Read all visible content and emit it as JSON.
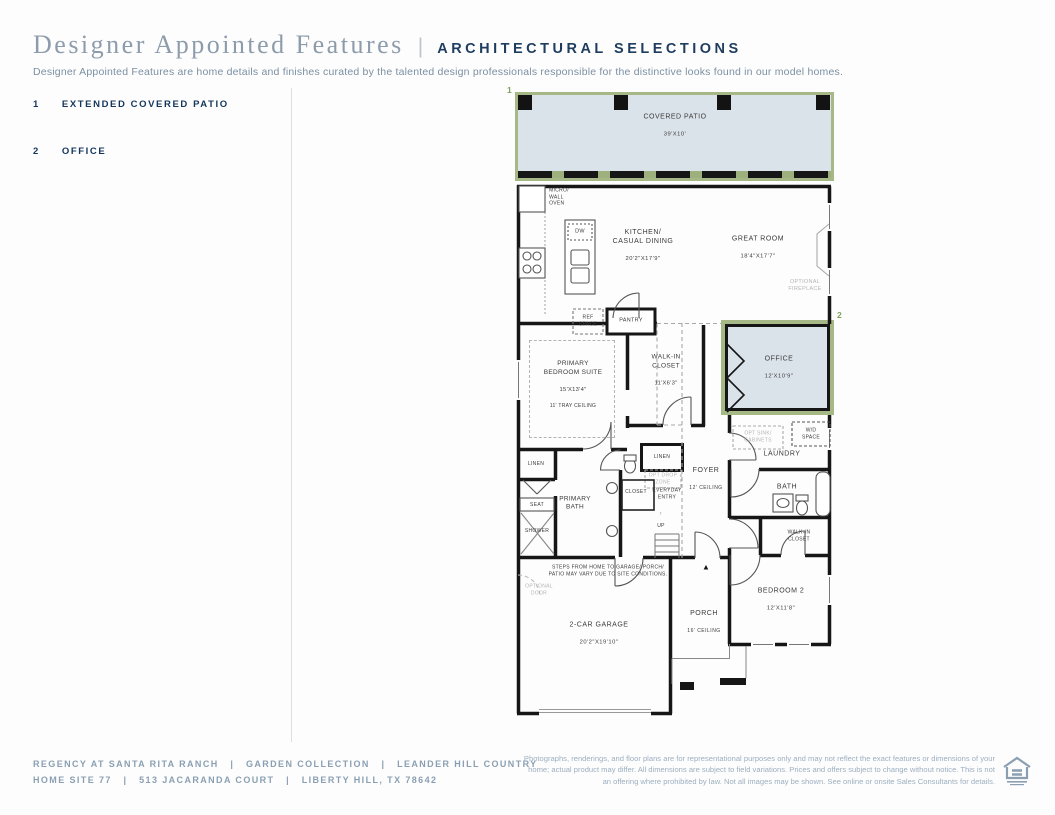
{
  "header": {
    "title": "Designer Appointed Features",
    "separator": "|",
    "category": "ARCHITECTURAL SELECTIONS",
    "description": "Designer Appointed Features are home details and finishes curated by the talented design professionals responsible for the distinctive looks found in our model homes."
  },
  "features": [
    {
      "number": "1",
      "label": "EXTENDED COVERED PATIO"
    },
    {
      "number": "2",
      "label": "OFFICE"
    }
  ],
  "plan": {
    "markers": {
      "patio": "1",
      "office": "2"
    },
    "covered_patio": {
      "label": "COVERED PATIO",
      "dims": "39'X10'"
    },
    "micro_wall_oven": "MICRO/\nWALL\nOVEN",
    "dw": "DW",
    "kitchen": {
      "label": "KITCHEN/\nCASUAL DINING",
      "dims": "20'2\"X17'9\""
    },
    "great_room": {
      "label": "GREAT ROOM",
      "dims": "18'4\"X17'7\""
    },
    "optional_fireplace": "OPTIONAL\nFIREPLACE",
    "ref_space": "REF\nSPACE",
    "pantry": "PANTRY",
    "office": {
      "label": "OFFICE",
      "dims": "12'X10'9\""
    },
    "opt_sink_cabinets": "OPT SINK/\nCABINETS",
    "wd_space": "W/D\nSPACE",
    "laundry": "LAUNDRY",
    "bath": "BATH",
    "walk_in_closet_2": "WALK-IN\nCLOSET",
    "bedroom_2": {
      "label": "BEDROOM 2",
      "dims": "12'X11'8\""
    },
    "porch": {
      "label": "PORCH",
      "ceiling": "16' CEILING"
    },
    "garage": {
      "label": "2-CAR GARAGE",
      "dims": "20'2\"X19'10\""
    },
    "primary_bedroom": {
      "label": "PRIMARY\nBEDROOM SUITE",
      "dims": "15'X13'4\"",
      "ceiling": "11' TRAY CEILING"
    },
    "walk_in_closet": {
      "label": "WALK-IN\nCLOSET",
      "dims": "11'X6'3\""
    },
    "linen_left": "LINEN",
    "linen_center": "LINEN",
    "opt_drop_zone": "OPT DROP\nZONE",
    "foyer": {
      "label": "FOYER",
      "ceiling": "12' CEILING"
    },
    "closet": "CLOSET",
    "everyday_entry": "EVERYDAY\nENTRY",
    "up_arrow": "↑",
    "up": "UP",
    "primary_bath": "PRIMARY\nBATH",
    "seat": "SEAT",
    "shower": "SHOWER",
    "steps_note": "STEPS FROM HOME TO GARAGE/ PORCH/\nPATIO MAY VARY DUE TO SITE CONDITIONS.",
    "optional_door": "OPTIONAL\nDOOR",
    "entry_marker": "▲"
  },
  "footer": {
    "line1": "REGENCY AT SANTA RITA RANCH   |   GARDEN COLLECTION   |   LEANDER HILL COUNTRY",
    "line2": "HOME SITE 77   |   513 JACARANDA COURT   |   LIBERTY HILL, TX 78642",
    "disclaimer": "Photographs, renderings, and floor plans are for representational purposes only and may not reflect the exact features or dimensions of your home; actual product may differ. All dimensions are subject to field variations. Prices and offers subject to change without notice. This is not an offering where prohibited by law. Not all images may be shown. See online or onsite Sales Consultants for details."
  },
  "colors": {
    "accent_navy": "#1e3d5f",
    "muted_slate": "#8d9cab",
    "highlight_fill": "#dbe3ea",
    "highlight_border": "#a5b886",
    "marker_green": "#7fa05a",
    "wall": "#161616"
  }
}
